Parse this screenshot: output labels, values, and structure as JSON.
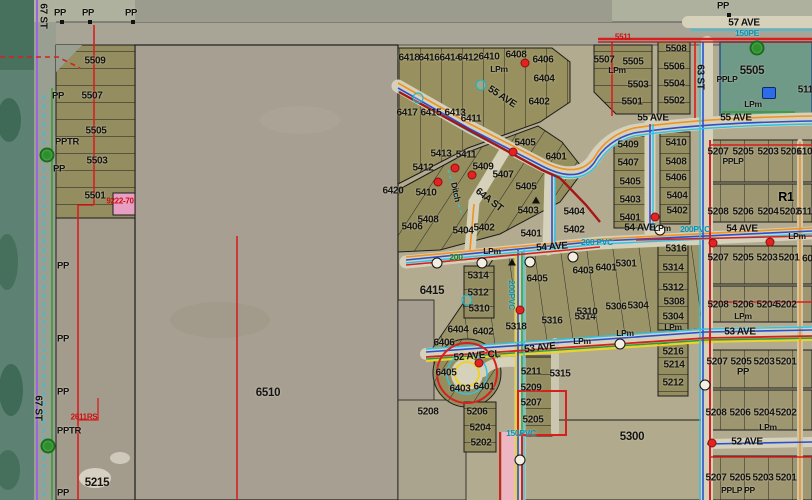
{
  "map": {
    "description": "GIS parcel and utility map view",
    "colors": {
      "parcel_olive": "#8f8a5e",
      "field_gray": "#a7a092",
      "vegetation_teal": "#5d8273",
      "teal_parcel": "#6f9a88",
      "power_red": "#d81f1f",
      "water_cyan": "#2cc3e6",
      "water_blue": "#2a4fd0",
      "gas_orange": "#f19222",
      "sewer_green": "#2f9e2f",
      "line_yellow": "#ecd22a",
      "row_purple": "#9a66e0",
      "selection_pink": "#eeb6c2",
      "label_black": "#141414",
      "plan_red": "#cc1010"
    },
    "labels": [
      {
        "t": "PP",
        "x": 60,
        "y": 13,
        "c": "sm10"
      },
      {
        "t": "PP",
        "x": 88,
        "y": 13,
        "c": "sm10"
      },
      {
        "t": "PP",
        "x": 131,
        "y": 13,
        "c": "sm10"
      },
      {
        "t": "67 ST",
        "x": 43,
        "y": 16,
        "c": "st",
        "r": 90
      },
      {
        "t": "67 ST",
        "x": 38,
        "y": 408,
        "c": "st",
        "r": 90
      },
      {
        "t": "5509",
        "x": 95,
        "y": 61
      },
      {
        "t": "PP",
        "x": 58,
        "y": 96,
        "c": "sm10"
      },
      {
        "t": "5507",
        "x": 92,
        "y": 96
      },
      {
        "t": "5505",
        "x": 96,
        "y": 131
      },
      {
        "t": "PPTR",
        "x": 67,
        "y": 142,
        "c": "sm10"
      },
      {
        "t": "5503",
        "x": 97,
        "y": 161
      },
      {
        "t": "PP",
        "x": 59,
        "y": 169,
        "c": "sm10"
      },
      {
        "t": "5501",
        "x": 95,
        "y": 196
      },
      {
        "t": "9222-70",
        "x": 120,
        "y": 201,
        "c": "rd"
      },
      {
        "t": "PP",
        "x": 63,
        "y": 266,
        "c": "sm10"
      },
      {
        "t": "PP",
        "x": 63,
        "y": 339,
        "c": "sm10"
      },
      {
        "t": "PP",
        "x": 63,
        "y": 392,
        "c": "sm10"
      },
      {
        "t": "2611RS",
        "x": 84,
        "y": 417,
        "c": "rd"
      },
      {
        "t": "PPTR",
        "x": 69,
        "y": 431,
        "c": "sm10"
      },
      {
        "t": "5215",
        "x": 97,
        "y": 483,
        "c": "big"
      },
      {
        "t": "PP",
        "x": 63,
        "y": 493,
        "c": "sm10"
      },
      {
        "t": "6510",
        "x": 268,
        "y": 393,
        "c": "big"
      },
      {
        "t": "6420",
        "x": 393,
        "y": 191
      },
      {
        "t": "6415",
        "x": 432,
        "y": 291,
        "c": "big"
      },
      {
        "t": "6418",
        "x": 409,
        "y": 58
      },
      {
        "t": "6416",
        "x": 429,
        "y": 58
      },
      {
        "t": "6414",
        "x": 450,
        "y": 58
      },
      {
        "t": "6412",
        "x": 468,
        "y": 58
      },
      {
        "t": "6410",
        "x": 489,
        "y": 57
      },
      {
        "t": "LPm",
        "x": 499,
        "y": 69,
        "c": "sm"
      },
      {
        "t": "6408",
        "x": 516,
        "y": 55
      },
      {
        "t": "6406",
        "x": 543,
        "y": 60
      },
      {
        "t": "6404",
        "x": 544,
        "y": 79
      },
      {
        "t": "6402",
        "x": 539,
        "y": 102
      },
      {
        "t": "55 AVE",
        "x": 502,
        "y": 97,
        "c": "st",
        "r": 33
      },
      {
        "t": "6417",
        "x": 407,
        "y": 113
      },
      {
        "t": "6415",
        "x": 431,
        "y": 113
      },
      {
        "t": "6413",
        "x": 455,
        "y": 113
      },
      {
        "t": "6411",
        "x": 471,
        "y": 119
      },
      {
        "t": "5405",
        "x": 525,
        "y": 143
      },
      {
        "t": "6401",
        "x": 556,
        "y": 157
      },
      {
        "t": "5413",
        "x": 441,
        "y": 154
      },
      {
        "t": "5411",
        "x": 466,
        "y": 155
      },
      {
        "t": "5412",
        "x": 423,
        "y": 168
      },
      {
        "t": "5409",
        "x": 483,
        "y": 167
      },
      {
        "t": "5407",
        "x": 503,
        "y": 175
      },
      {
        "t": "5410",
        "x": 426,
        "y": 193
      },
      {
        "t": "5405",
        "x": 526,
        "y": 187
      },
      {
        "t": "5403",
        "x": 528,
        "y": 211
      },
      {
        "t": "64A ST",
        "x": 489,
        "y": 200,
        "c": "st",
        "r": 38
      },
      {
        "t": "Ditch",
        "x": 456,
        "y": 192,
        "c": "sm",
        "r": 78
      },
      {
        "t": "5408",
        "x": 428,
        "y": 220
      },
      {
        "t": "5406",
        "x": 412,
        "y": 227
      },
      {
        "t": "5404",
        "x": 463,
        "y": 231
      },
      {
        "t": "5402",
        "x": 484,
        "y": 228
      },
      {
        "t": "5401",
        "x": 531,
        "y": 234
      },
      {
        "t": "5404",
        "x": 574,
        "y": 212
      },
      {
        "t": "5402",
        "x": 574,
        "y": 230
      },
      {
        "t": "54 AVE",
        "x": 552,
        "y": 247,
        "c": "st",
        "r": -4
      },
      {
        "t": "LPm",
        "x": 492,
        "y": 251,
        "c": "sm"
      },
      {
        "t": "200",
        "x": 456,
        "y": 257,
        "c": "gr"
      },
      {
        "t": "200 PVC",
        "x": 597,
        "y": 242,
        "c": "cy"
      },
      {
        "t": "5314",
        "x": 478,
        "y": 276
      },
      {
        "t": "5312",
        "x": 478,
        "y": 293
      },
      {
        "t": "5310",
        "x": 479,
        "y": 309
      },
      {
        "t": "6404",
        "x": 458,
        "y": 330
      },
      {
        "t": "6402",
        "x": 483,
        "y": 332
      },
      {
        "t": "6406",
        "x": 444,
        "y": 343
      },
      {
        "t": "6405",
        "x": 446,
        "y": 373
      },
      {
        "t": "6403",
        "x": 460,
        "y": 389
      },
      {
        "t": "6401",
        "x": 484,
        "y": 387
      },
      {
        "t": "52 AVE CL",
        "x": 477,
        "y": 356,
        "c": "st",
        "r": -5
      },
      {
        "t": "5318",
        "x": 516,
        "y": 327
      },
      {
        "t": "5316",
        "x": 552,
        "y": 321
      },
      {
        "t": "5314",
        "x": 585,
        "y": 317
      },
      {
        "t": "53 AVE",
        "x": 540,
        "y": 348,
        "c": "st",
        "r": -7
      },
      {
        "t": "LPm",
        "x": 582,
        "y": 341,
        "c": "sm"
      },
      {
        "t": "5315",
        "x": 560,
        "y": 374
      },
      {
        "t": "5211",
        "x": 531,
        "y": 372
      },
      {
        "t": "5209",
        "x": 531,
        "y": 388
      },
      {
        "t": "5207",
        "x": 531,
        "y": 403
      },
      {
        "t": "5205",
        "x": 533,
        "y": 420
      },
      {
        "t": "5208",
        "x": 428,
        "y": 412
      },
      {
        "t": "5206",
        "x": 477,
        "y": 412
      },
      {
        "t": "5204",
        "x": 480,
        "y": 428
      },
      {
        "t": "5202",
        "x": 481,
        "y": 443
      },
      {
        "t": "150PVC",
        "x": 521,
        "y": 433,
        "c": "cy"
      },
      {
        "t": "5300",
        "x": 632,
        "y": 437,
        "c": "big"
      },
      {
        "t": "6405",
        "x": 537,
        "y": 279
      },
      {
        "t": "6403",
        "x": 583,
        "y": 271
      },
      {
        "t": "6401",
        "x": 606,
        "y": 268
      },
      {
        "t": "5301",
        "x": 626,
        "y": 264
      },
      {
        "t": "5310",
        "x": 587,
        "y": 312
      },
      {
        "t": "5306",
        "x": 616,
        "y": 307
      },
      {
        "t": "5304",
        "x": 638,
        "y": 306
      },
      {
        "t": "5316",
        "x": 676,
        "y": 249
      },
      {
        "t": "5314",
        "x": 673,
        "y": 268
      },
      {
        "t": "5312",
        "x": 673,
        "y": 288
      },
      {
        "t": "5308",
        "x": 674,
        "y": 302
      },
      {
        "t": "5304",
        "x": 673,
        "y": 317
      },
      {
        "t": "LPm",
        "x": 673,
        "y": 327,
        "c": "sm"
      },
      {
        "t": "5216",
        "x": 673,
        "y": 352
      },
      {
        "t": "5214",
        "x": 674,
        "y": 365
      },
      {
        "t": "5212",
        "x": 673,
        "y": 383
      },
      {
        "t": "200PVC",
        "x": 512,
        "y": 295,
        "c": "cy",
        "r": 90
      },
      {
        "t": "5409",
        "x": 628,
        "y": 145
      },
      {
        "t": "5407",
        "x": 628,
        "y": 163
      },
      {
        "t": "5405",
        "x": 630,
        "y": 182
      },
      {
        "t": "5403",
        "x": 630,
        "y": 200
      },
      {
        "t": "5401",
        "x": 630,
        "y": 218
      },
      {
        "t": "5410",
        "x": 676,
        "y": 143
      },
      {
        "t": "5408",
        "x": 676,
        "y": 162
      },
      {
        "t": "5406",
        "x": 676,
        "y": 178
      },
      {
        "t": "5404",
        "x": 677,
        "y": 196
      },
      {
        "t": "5402",
        "x": 677,
        "y": 211
      },
      {
        "t": "5511",
        "x": 623,
        "y": 37,
        "c": "rd"
      },
      {
        "t": "5507",
        "x": 604,
        "y": 60
      },
      {
        "t": "5505",
        "x": 633,
        "y": 62
      },
      {
        "t": "LPm",
        "x": 617,
        "y": 70,
        "c": "sm"
      },
      {
        "t": "5503",
        "x": 638,
        "y": 85
      },
      {
        "t": "5501",
        "x": 632,
        "y": 102
      },
      {
        "t": "5508",
        "x": 676,
        "y": 49
      },
      {
        "t": "5506",
        "x": 674,
        "y": 67
      },
      {
        "t": "5504",
        "x": 674,
        "y": 84
      },
      {
        "t": "5502",
        "x": 674,
        "y": 101
      },
      {
        "t": "55 AVE",
        "x": 653,
        "y": 118,
        "c": "st"
      },
      {
        "t": "55 AVE",
        "x": 736,
        "y": 118,
        "c": "st"
      },
      {
        "t": "63 ST",
        "x": 700,
        "y": 77,
        "c": "st",
        "r": 90
      },
      {
        "t": "PP",
        "x": 723,
        "y": 6,
        "c": "sm10"
      },
      {
        "t": "57 AVE",
        "x": 744,
        "y": 23,
        "c": "st"
      },
      {
        "t": "150PE",
        "x": 747,
        "y": 33,
        "c": "cy"
      },
      {
        "t": "5505",
        "x": 752,
        "y": 71,
        "c": "big"
      },
      {
        "t": "PPLP",
        "x": 727,
        "y": 79,
        "c": "sm"
      },
      {
        "t": "LPm",
        "x": 753,
        "y": 104,
        "c": "sm"
      },
      {
        "t": "5110",
        "x": 808,
        "y": 90
      },
      {
        "t": "5207",
        "x": 718,
        "y": 152
      },
      {
        "t": "5205",
        "x": 743,
        "y": 152
      },
      {
        "t": "5203",
        "x": 768,
        "y": 152
      },
      {
        "t": "5201",
        "x": 791,
        "y": 152
      },
      {
        "t": "6109",
        "x": 807,
        "y": 152
      },
      {
        "t": "PPLP",
        "x": 733,
        "y": 161,
        "c": "sm"
      },
      {
        "t": "R1",
        "x": 786,
        "y": 197,
        "c": "zone"
      },
      {
        "t": "5208",
        "x": 718,
        "y": 212
      },
      {
        "t": "5206",
        "x": 743,
        "y": 212
      },
      {
        "t": "5204",
        "x": 768,
        "y": 212
      },
      {
        "t": "5202",
        "x": 790,
        "y": 212
      },
      {
        "t": "6110",
        "x": 807,
        "y": 212
      },
      {
        "t": "54 AVE",
        "x": 640,
        "y": 228,
        "c": "st"
      },
      {
        "t": "LPm",
        "x": 662,
        "y": 228,
        "c": "sm"
      },
      {
        "t": "200PVC",
        "x": 695,
        "y": 229,
        "c": "cy"
      },
      {
        "t": "54 AVE",
        "x": 742,
        "y": 229,
        "c": "st"
      },
      {
        "t": "LPm",
        "x": 797,
        "y": 236,
        "c": "sm"
      },
      {
        "t": "5207",
        "x": 718,
        "y": 258
      },
      {
        "t": "5205",
        "x": 743,
        "y": 258
      },
      {
        "t": "5203",
        "x": 767,
        "y": 258
      },
      {
        "t": "5201",
        "x": 789,
        "y": 258
      },
      {
        "t": "601",
        "x": 810,
        "y": 259
      },
      {
        "t": "5208",
        "x": 718,
        "y": 305
      },
      {
        "t": "5206",
        "x": 743,
        "y": 305
      },
      {
        "t": "5204",
        "x": 767,
        "y": 305
      },
      {
        "t": "5202",
        "x": 786,
        "y": 305
      },
      {
        "t": "LPm",
        "x": 743,
        "y": 316,
        "c": "sm"
      },
      {
        "t": "53 AVE",
        "x": 740,
        "y": 332,
        "c": "st"
      },
      {
        "t": "LPm",
        "x": 625,
        "y": 333,
        "c": "sm"
      },
      {
        "t": "5207",
        "x": 717,
        "y": 362
      },
      {
        "t": "5205",
        "x": 741,
        "y": 362
      },
      {
        "t": "5203",
        "x": 764,
        "y": 362
      },
      {
        "t": "5201",
        "x": 786,
        "y": 362
      },
      {
        "t": "PP",
        "x": 743,
        "y": 372,
        "c": "sm10"
      },
      {
        "t": "5208",
        "x": 716,
        "y": 413
      },
      {
        "t": "5206",
        "x": 740,
        "y": 413
      },
      {
        "t": "5204",
        "x": 764,
        "y": 413
      },
      {
        "t": "5202",
        "x": 786,
        "y": 413
      },
      {
        "t": "LPm",
        "x": 768,
        "y": 427,
        "c": "sm"
      },
      {
        "t": "52 AVE",
        "x": 747,
        "y": 442,
        "c": "st"
      },
      {
        "t": "5207",
        "x": 716,
        "y": 478
      },
      {
        "t": "5205",
        "x": 740,
        "y": 478
      },
      {
        "t": "5203",
        "x": 763,
        "y": 478
      },
      {
        "t": "5201",
        "x": 786,
        "y": 478
      },
      {
        "t": "PPLP PP",
        "x": 738,
        "y": 490,
        "c": "sm"
      }
    ],
    "symbols": [
      {
        "type": "tree",
        "x": 47,
        "y": 155
      },
      {
        "type": "tree",
        "x": 48,
        "y": 446
      },
      {
        "type": "tree",
        "x": 757,
        "y": 48
      },
      {
        "type": "transformer",
        "x": 769,
        "y": 93
      },
      {
        "type": "manhole",
        "x": 437,
        "y": 263
      },
      {
        "type": "manhole",
        "x": 482,
        "y": 263
      },
      {
        "type": "manhole",
        "x": 530,
        "y": 262
      },
      {
        "type": "manhole",
        "x": 573,
        "y": 257
      },
      {
        "type": "manhole",
        "x": 660,
        "y": 230
      },
      {
        "type": "manhole",
        "x": 620,
        "y": 344
      },
      {
        "type": "manhole",
        "x": 705,
        "y": 385
      },
      {
        "type": "manhole",
        "x": 520,
        "y": 460
      },
      {
        "type": "hydrant",
        "x": 455,
        "y": 168
      },
      {
        "type": "hydrant",
        "x": 472,
        "y": 175
      },
      {
        "type": "hydrant",
        "x": 438,
        "y": 182
      },
      {
        "type": "hydrant",
        "x": 513,
        "y": 152
      },
      {
        "type": "hydrant",
        "x": 525,
        "y": 63
      },
      {
        "type": "hydrant",
        "x": 655,
        "y": 217
      },
      {
        "type": "hydrant",
        "x": 713,
        "y": 243
      },
      {
        "type": "hydrant",
        "x": 770,
        "y": 242
      },
      {
        "type": "hydrant",
        "x": 479,
        "y": 363
      },
      {
        "type": "hydrant",
        "x": 520,
        "y": 310
      },
      {
        "type": "hydrant",
        "x": 712,
        "y": 443
      },
      {
        "type": "valve",
        "x": 481,
        "y": 85
      },
      {
        "type": "valve",
        "x": 467,
        "y": 300
      },
      {
        "type": "valve",
        "x": 418,
        "y": 98
      },
      {
        "type": "gas-valve",
        "x": 536,
        "y": 200
      },
      {
        "type": "gas-valve",
        "x": 512,
        "y": 262
      },
      {
        "type": "pole",
        "x": 62,
        "y": 22
      },
      {
        "type": "pole",
        "x": 90,
        "y": 22
      },
      {
        "type": "pole",
        "x": 133,
        "y": 22
      },
      {
        "type": "pole",
        "x": 729,
        "y": 15
      }
    ]
  }
}
